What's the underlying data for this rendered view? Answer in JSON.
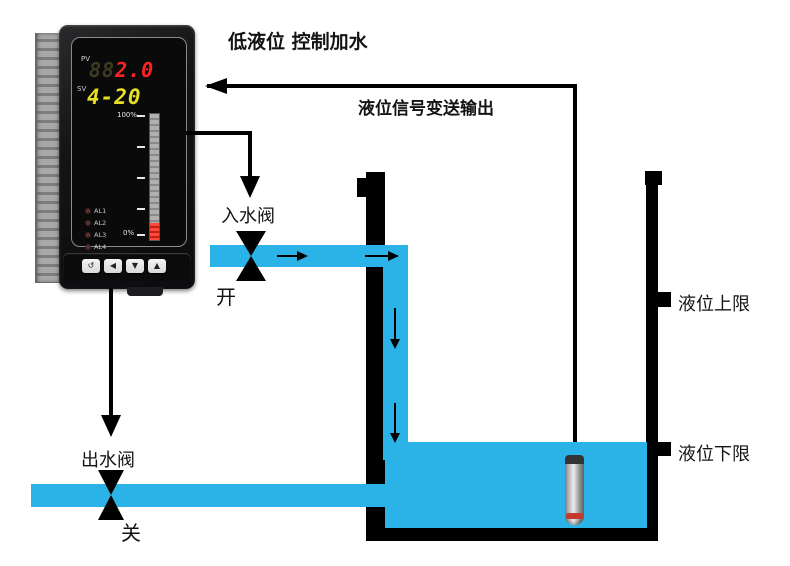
{
  "title": "低液位 控制加水",
  "signal": {
    "label": "液位信号变送输出"
  },
  "controller": {
    "pv_label": "PV",
    "pv_ghost": "88",
    "pv_value": "2.0",
    "sv_label": "SV",
    "sv_value": "4-20",
    "scale_top": "100%",
    "scale_bottom": "0%",
    "leds": [
      "AL1",
      "AL2",
      "AL3",
      "AL4"
    ],
    "buttons": [
      "↺",
      "◀",
      "▼",
      "▲"
    ]
  },
  "inlet_valve": {
    "label": "入水阀",
    "state": "开"
  },
  "outlet_valve": {
    "label": "出水阀",
    "state": "关"
  },
  "tank": {
    "upper_limit_label": "液位上限",
    "lower_limit_label": "液位下限"
  },
  "colors": {
    "water": "#2bb3e8",
    "pv_red": "#ff2222",
    "sv_yellow": "#e6e021",
    "line": "#000000"
  }
}
